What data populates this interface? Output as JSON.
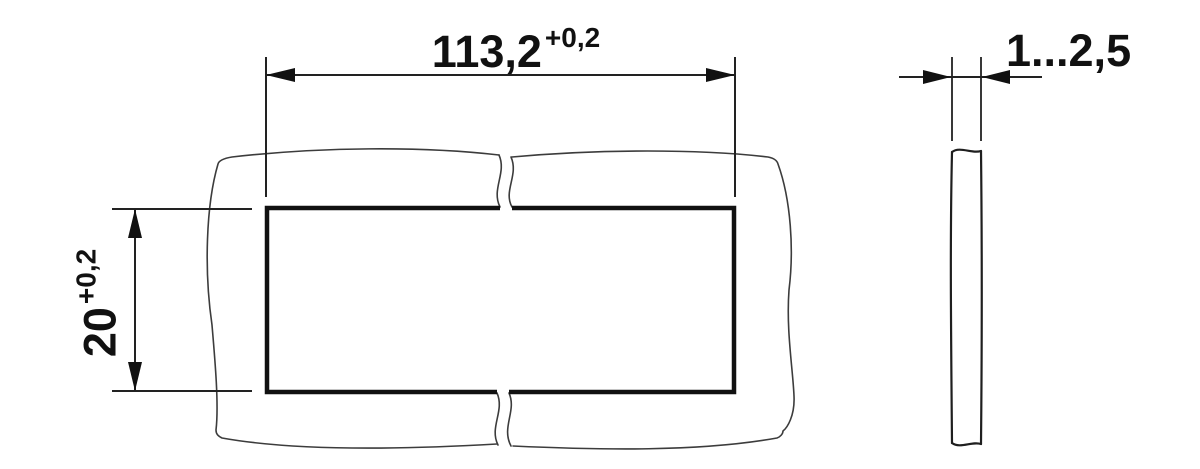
{
  "drawing": {
    "front_view": {
      "width_dimension": {
        "value": "113,2",
        "tolerance": "+0,2"
      },
      "height_dimension": {
        "value": "20",
        "tolerance": "+0,2"
      }
    },
    "side_view": {
      "thickness_dimension": {
        "value": "1...2,5"
      }
    },
    "colors": {
      "line": "#1a1a1a",
      "thin_line": "#3c3c3c",
      "background": "#ffffff"
    }
  }
}
